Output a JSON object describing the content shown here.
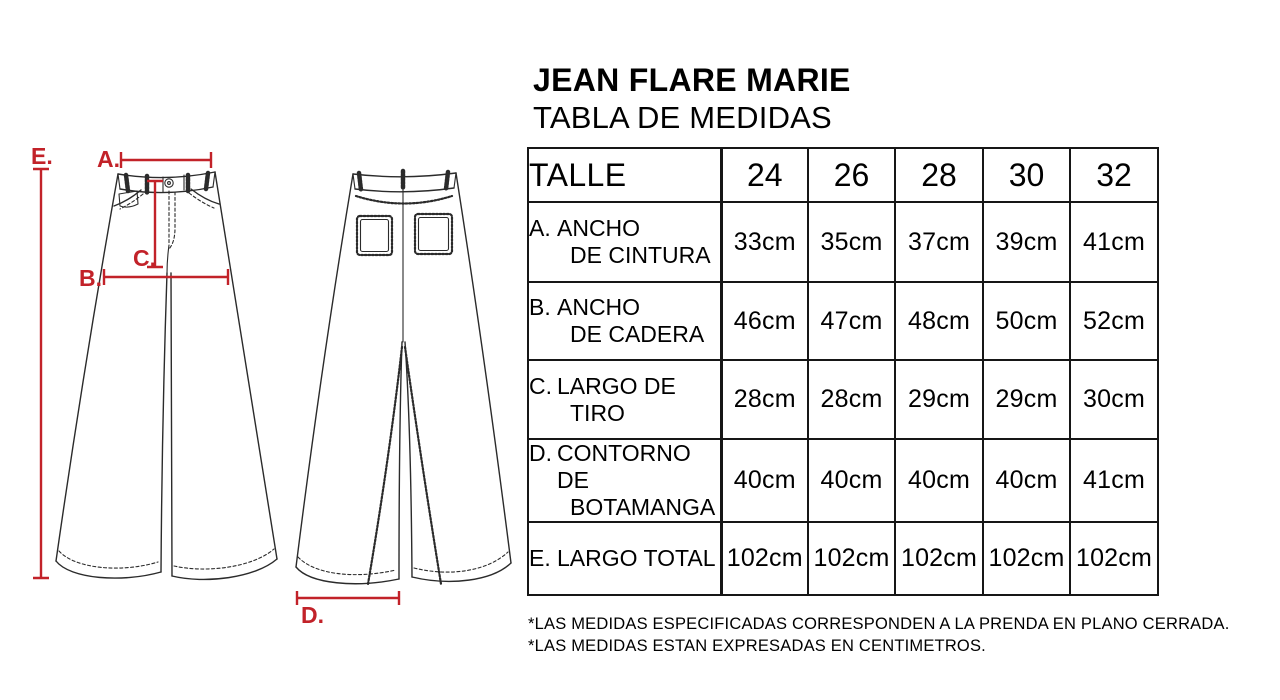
{
  "title": "JEAN FLARE MARIE",
  "subtitle": "TABLA DE MEDIDAS",
  "diagram": {
    "accent_color": "#C22229",
    "line_color": "#2b2b2b",
    "annotations": {
      "E": "E.",
      "A": "A.",
      "C": "C.",
      "B": "B.",
      "D": "D."
    },
    "views": [
      "jeans-front-flat-sketch",
      "jeans-back-flat-sketch"
    ]
  },
  "size_table": {
    "header": {
      "label": "TALLE",
      "sizes": [
        "24",
        "26",
        "28",
        "30",
        "32"
      ]
    },
    "rows": [
      {
        "prefix": "A.",
        "line1": "ANCHO",
        "line2": "DE CINTURA",
        "values": [
          "33cm",
          "35cm",
          "37cm",
          "39cm",
          "41cm"
        ]
      },
      {
        "prefix": "B.",
        "line1": "ANCHO",
        "line2": "DE CADERA",
        "values": [
          "46cm",
          "47cm",
          "48cm",
          "50cm",
          "52cm"
        ]
      },
      {
        "prefix": "C.",
        "line1": "LARGO DE",
        "line2": "TIRO",
        "values": [
          "28cm",
          "28cm",
          "29cm",
          "29cm",
          "30cm"
        ]
      },
      {
        "prefix": "D.",
        "line1": "CONTORNO DE",
        "line2": "BOTAMANGA",
        "values": [
          "40cm",
          "40cm",
          "40cm",
          "40cm",
          "41cm"
        ]
      },
      {
        "prefix": "E.",
        "line1": "LARGO TOTAL",
        "line2": "",
        "values": [
          "102cm",
          "102cm",
          "102cm",
          "102cm",
          "102cm"
        ]
      }
    ]
  },
  "footnotes": [
    "*LAS MEDIDAS ESPECIFICADAS CORRESPONDEN A LA PRENDA EN PLANO CERRADA.",
    "*LAS MEDIDAS ESTAN EXPRESADAS EN CENTIMETROS."
  ]
}
